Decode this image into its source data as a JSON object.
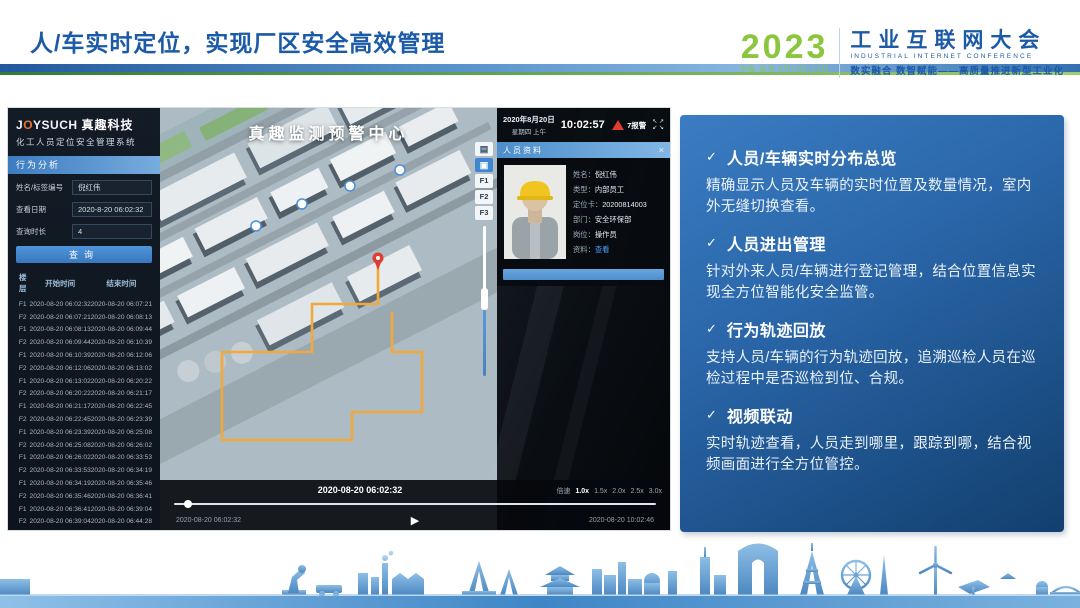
{
  "slide": {
    "title": "人/车实时定位，实现厂区安全高效管理",
    "accent_blue": "#1b5aa6",
    "accent_green": "#8cc63f"
  },
  "conference_logo": {
    "year": "2023",
    "venue_line": "中国·苏州 9月11日-13日",
    "name_cn": "工业互联网大会",
    "name_en": "INDUSTRIAL INTERNET CONFERENCE",
    "slogan": "数实融合 数智赋能——高质量推进新型工业化"
  },
  "app": {
    "brand": {
      "logo": "JOYSUCH",
      "brand_cn": "真趣科技",
      "system_name": "化工人员定位安全管理系统"
    },
    "sidebar": {
      "section_title": "行为分析",
      "fields": [
        {
          "label": "姓名/标签编号",
          "value": "倪红伟"
        },
        {
          "label": "查看日期",
          "value": "2020-8-20 06:02:32"
        },
        {
          "label": "查询时长",
          "value": "4"
        }
      ],
      "search_button": "查询",
      "table": {
        "headers": [
          "楼层",
          "开始时间",
          "结束时间"
        ],
        "rows": [
          [
            "F1",
            "2020-08-20 06:02:32",
            "2020-08-20 06:07:21"
          ],
          [
            "F2",
            "2020-08-20 06:07:21",
            "2020-08-20 06:08:13"
          ],
          [
            "F1",
            "2020-08-20 06:08:13",
            "2020-08-20 06:09:44"
          ],
          [
            "F2",
            "2020-08-20 06:09:44",
            "2020-08-20 06:10:39"
          ],
          [
            "F1",
            "2020-08-20 06:10:39",
            "2020-08-20 06:12:06"
          ],
          [
            "F2",
            "2020-08-20 06:12:06",
            "2020-08-20 06:13:02"
          ],
          [
            "F1",
            "2020-08-20 06:13:02",
            "2020-08-20 06:20:22"
          ],
          [
            "F2",
            "2020-08-20 06:20:22",
            "2020-08-20 06:21:17"
          ],
          [
            "F1",
            "2020-08-20 06:21:17",
            "2020-08-20 06:22:45"
          ],
          [
            "F2",
            "2020-08-20 06:22:45",
            "2020-08-20 06:23:39"
          ],
          [
            "F1",
            "2020-08-20 06:23:39",
            "2020-08-20 06:25:08"
          ],
          [
            "F2",
            "2020-08-20 06:25:08",
            "2020-08-20 06:26:02"
          ],
          [
            "F1",
            "2020-08-20 06:26:02",
            "2020-08-20 06:33:53"
          ],
          [
            "F2",
            "2020-08-20 06:33:53",
            "2020-08-20 06:34:19"
          ],
          [
            "F1",
            "2020-08-20 06:34:19",
            "2020-08-20 06:35:46"
          ],
          [
            "F2",
            "2020-08-20 06:35:46",
            "2020-08-20 06:36:41"
          ],
          [
            "F1",
            "2020-08-20 06:36:41",
            "2020-08-20 06:39:04"
          ],
          [
            "F2",
            "2020-08-20 06:39:04",
            "2020-08-20 06:44:28"
          ],
          [
            "F1",
            "2020-08-20 06:44:28",
            "2020-08-20 06:47:19"
          ],
          [
            "F2",
            "2020-08-20 06:47:19",
            "2020-08-20 06:51:09"
          ]
        ]
      }
    },
    "map": {
      "title": "真趣监测预警中心",
      "floor_buttons": [
        "F1",
        "F2",
        "F3"
      ],
      "path_color": "#f2a93b",
      "alarm_marker_color": "#e03c31"
    },
    "status_bar": {
      "date": "2020年8月20日",
      "weekday": "星期四 上午",
      "time": "10:02:57",
      "alarm_badge": "7报警"
    },
    "person_panel": {
      "title": "人员资料",
      "close_glyph": "×",
      "fields": [
        {
          "label": "姓名：",
          "value": "倪红伟"
        },
        {
          "label": "类型：",
          "value": "内部员工"
        },
        {
          "label": "定位卡：",
          "value": "20200814003"
        },
        {
          "label": "部门：",
          "value": "安全环保部"
        },
        {
          "label": "岗位：",
          "value": "操作员"
        },
        {
          "label": "资料：",
          "value": "查看",
          "link": true
        }
      ]
    },
    "timeline": {
      "current_time": "2020-08-20 06:02:32",
      "speed_label": "倍速",
      "speeds": [
        "1.0x",
        "1.5x",
        "2.0x",
        "2.5x",
        "3.0x"
      ],
      "active_speed": "1.0x",
      "start_time": "2020-08-20 06:02:32",
      "end_time": "2020-08-20 10:02:46",
      "play_glyph": "▶"
    }
  },
  "features_check": "✓",
  "features": [
    {
      "title": "人员/车辆实时分布总览",
      "body": "精确显示人员及车辆的实时位置及数量情况，室内外无缝切换查看。"
    },
    {
      "title": "人员进出管理",
      "body": "针对外来人员/车辆进行登记管理，结合位置信息实现全方位智能化安全监管。"
    },
    {
      "title": "行为轨迹回放",
      "body": "支持人员/车辆的行为轨迹回放，追溯巡检人员在巡检过程中是否巡检到位、合规。"
    },
    {
      "title": "视频联动",
      "body": "实时轨迹查看，人员走到哪里，跟踪到哪，结合视频画面进行全方位管控。"
    }
  ]
}
